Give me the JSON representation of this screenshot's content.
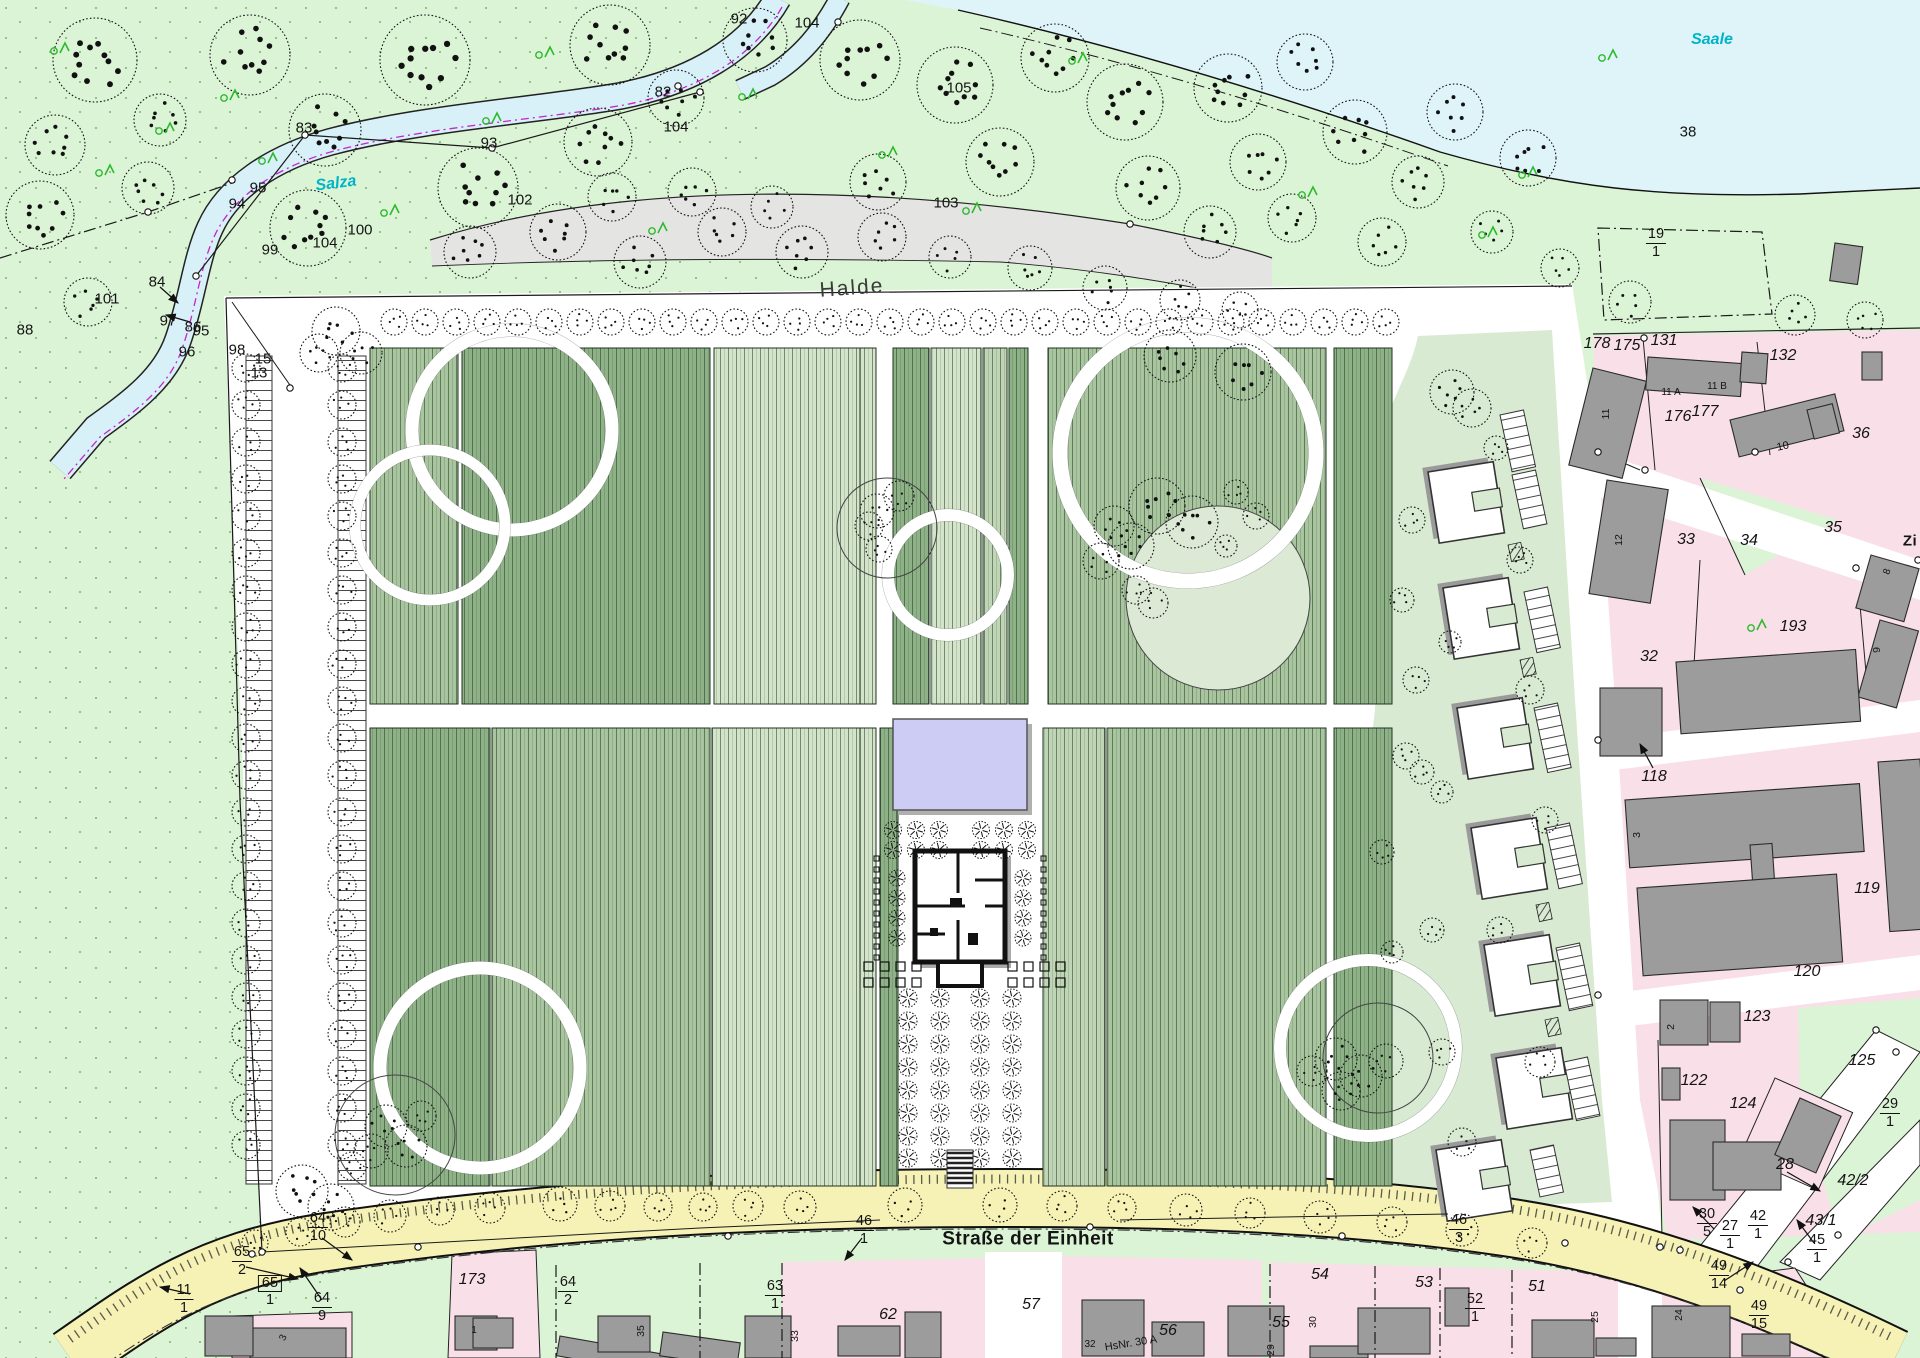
{
  "map": {
    "colors": {
      "meadow": "#dcf4d6",
      "field_dot": "#7fae74",
      "water": "#def4f8",
      "halde": "#e4e4e2",
      "park": "#ffffff",
      "plot_dark": "#8fb188",
      "plot_mid": "#a9c5a0",
      "plot_pale": "#d4e4cb",
      "plot_mix": "#c0d5b6",
      "pavilion_strip": "#d8ead2",
      "residential": "#f9dfe8",
      "building": "#9c9c9c",
      "road_yellow": "#f6f2b6",
      "pond": "#ccccf4",
      "river_label": "#00b4c8",
      "green_symbol": "#2db92d",
      "line": "#1a1a1a"
    },
    "labels": [
      {
        "t": "83",
        "x": 304,
        "y": 128
      },
      {
        "t": "93",
        "x": 489,
        "y": 143
      },
      {
        "t": "95",
        "x": 258,
        "y": 188
      },
      {
        "t": "94",
        "x": 237,
        "y": 204
      },
      {
        "t": "102",
        "x": 520,
        "y": 200
      },
      {
        "t": "100",
        "x": 360,
        "y": 230
      },
      {
        "t": "104",
        "x": 325,
        "y": 243
      },
      {
        "t": "99",
        "x": 270,
        "y": 250
      },
      {
        "t": "84",
        "x": 157,
        "y": 282
      },
      {
        "t": "86",
        "x": 193,
        "y": 327
      },
      {
        "t": "96",
        "x": 187,
        "y": 352
      },
      {
        "t": "98",
        "x": 237,
        "y": 350
      },
      {
        "t": "15",
        "x": 263,
        "y": 359
      },
      {
        "t": "101",
        "x": 107,
        "y": 299
      },
      {
        "t": "97",
        "x": 168,
        "y": 321
      },
      {
        "t": "95",
        "x": 201,
        "y": 331
      },
      {
        "t": "88",
        "x": 25,
        "y": 330
      },
      {
        "t": "13",
        "x": 259,
        "y": 373
      },
      {
        "t": "92",
        "x": 739,
        "y": 19
      },
      {
        "t": "104",
        "x": 807,
        "y": 23
      },
      {
        "t": "82",
        "x": 663,
        "y": 92
      },
      {
        "t": "104",
        "x": 676,
        "y": 127
      },
      {
        "t": "105",
        "x": 959,
        "y": 88
      },
      {
        "t": "103",
        "x": 946,
        "y": 203
      },
      {
        "t": "Halde",
        "x": 852,
        "y": 288,
        "k": "area",
        "rot": -4
      },
      {
        "t": "Salza",
        "x": 336,
        "y": 184,
        "k": "river",
        "rot": -7
      },
      {
        "t": "Saale",
        "x": 1712,
        "y": 40,
        "k": "river"
      },
      {
        "t": "38",
        "x": 1688,
        "y": 132
      },
      {
        "t": "19/1",
        "x": 1656,
        "y": 243,
        "k": "frac"
      },
      {
        "t": "178",
        "x": 1597,
        "y": 344,
        "k": "i"
      },
      {
        "t": "175",
        "x": 1627,
        "y": 346,
        "k": "i"
      },
      {
        "t": "131",
        "x": 1664,
        "y": 341,
        "k": "i"
      },
      {
        "t": "132",
        "x": 1783,
        "y": 356,
        "k": "i"
      },
      {
        "t": "11 A",
        "x": 1671,
        "y": 393,
        "fs": 10
      },
      {
        "t": "11 B",
        "x": 1717,
        "y": 387,
        "fs": 10
      },
      {
        "t": "11",
        "x": 1606,
        "y": 414,
        "k": "v"
      },
      {
        "t": "176",
        "x": 1678,
        "y": 417,
        "k": "i"
      },
      {
        "t": "177",
        "x": 1705,
        "y": 412,
        "k": "i"
      },
      {
        "t": "10",
        "x": 1783,
        "y": 447,
        "fs": 11,
        "rot": -12
      },
      {
        "t": "36",
        "x": 1861,
        "y": 434,
        "k": "i"
      },
      {
        "t": "33",
        "x": 1686,
        "y": 540,
        "k": "i"
      },
      {
        "t": "34",
        "x": 1749,
        "y": 541,
        "k": "i"
      },
      {
        "t": "35",
        "x": 1833,
        "y": 528,
        "k": "i"
      },
      {
        "t": "12",
        "x": 1619,
        "y": 540,
        "k": "v"
      },
      {
        "t": "193",
        "x": 1793,
        "y": 627,
        "k": "i"
      },
      {
        "t": "Zi",
        "x": 1910,
        "y": 541,
        "k": "street",
        "fs": 15
      },
      {
        "t": "8",
        "x": 1888,
        "y": 572,
        "fs": 10,
        "rot": -70
      },
      {
        "t": "9",
        "x": 1877,
        "y": 650,
        "k": "v"
      },
      {
        "t": "32",
        "x": 1649,
        "y": 657,
        "k": "i"
      },
      {
        "t": "118",
        "x": 1654,
        "y": 777,
        "k": "i"
      },
      {
        "t": "3",
        "x": 1637,
        "y": 835,
        "k": "v"
      },
      {
        "t": "119",
        "x": 1867,
        "y": 889,
        "k": "i"
      },
      {
        "t": "120",
        "x": 1807,
        "y": 972,
        "k": "i"
      },
      {
        "t": "2",
        "x": 1671,
        "y": 1027,
        "k": "v"
      },
      {
        "t": "123",
        "x": 1757,
        "y": 1017,
        "k": "i"
      },
      {
        "t": "122",
        "x": 1694,
        "y": 1081,
        "k": "i"
      },
      {
        "t": "124",
        "x": 1743,
        "y": 1104,
        "k": "i"
      },
      {
        "t": "125",
        "x": 1862,
        "y": 1061,
        "k": "i"
      },
      {
        "t": "28",
        "x": 1785,
        "y": 1165,
        "k": "i"
      },
      {
        "t": "29/1",
        "x": 1890,
        "y": 1113,
        "k": "frac"
      },
      {
        "t": "42/2",
        "x": 1853,
        "y": 1181,
        "k": "i"
      },
      {
        "t": "43/1",
        "x": 1821,
        "y": 1221,
        "k": "i"
      },
      {
        "t": "30/5",
        "x": 1707,
        "y": 1223,
        "k": "frac"
      },
      {
        "t": "27/1",
        "x": 1730,
        "y": 1235,
        "k": "frac"
      },
      {
        "t": "42/1",
        "x": 1758,
        "y": 1225,
        "k": "frac"
      },
      {
        "t": "45/1",
        "x": 1817,
        "y": 1249,
        "k": "frac"
      },
      {
        "t": "49/14",
        "x": 1719,
        "y": 1275,
        "k": "frac"
      },
      {
        "t": "49/15",
        "x": 1759,
        "y": 1315,
        "k": "frac"
      },
      {
        "t": "24",
        "x": 1679,
        "y": 1315,
        "k": "v"
      },
      {
        "t": "25",
        "x": 1595,
        "y": 1317,
        "k": "v"
      },
      {
        "t": "Straße der Einheit",
        "x": 1028,
        "y": 1239,
        "k": "street"
      },
      {
        "t": "46/1",
        "x": 864,
        "y": 1230,
        "k": "frac"
      },
      {
        "t": "46/3",
        "x": 1459,
        "y": 1229,
        "k": "frac"
      },
      {
        "t": "64/10",
        "x": 318,
        "y": 1227,
        "k": "frac"
      },
      {
        "t": "65/2",
        "x": 242,
        "y": 1261,
        "k": "frac"
      },
      {
        "t": "65/1",
        "x": 270,
        "y": 1291,
        "k": "fracbox"
      },
      {
        "t": "11/1",
        "x": 184,
        "y": 1299,
        "k": "frac"
      },
      {
        "t": "64/9",
        "x": 322,
        "y": 1307,
        "k": "frac"
      },
      {
        "t": "173",
        "x": 472,
        "y": 1280,
        "k": "i"
      },
      {
        "t": "1",
        "x": 474,
        "y": 1331,
        "fs": 10
      },
      {
        "t": "3",
        "x": 284,
        "y": 1338,
        "fs": 10,
        "rot": -65
      },
      {
        "t": "64/2",
        "x": 568,
        "y": 1291,
        "k": "frac"
      },
      {
        "t": "63/1",
        "x": 775,
        "y": 1295,
        "k": "frac"
      },
      {
        "t": "62",
        "x": 888,
        "y": 1315,
        "k": "i"
      },
      {
        "t": "57",
        "x": 1031,
        "y": 1305,
        "k": "i"
      },
      {
        "t": "56",
        "x": 1168,
        "y": 1331,
        "k": "i"
      },
      {
        "t": "HsNr. 30 A",
        "x": 1131,
        "y": 1344,
        "fs": 11,
        "rot": -9
      },
      {
        "t": "55",
        "x": 1281,
        "y": 1323,
        "k": "i"
      },
      {
        "t": "54",
        "x": 1320,
        "y": 1275,
        "k": "i"
      },
      {
        "t": "53",
        "x": 1424,
        "y": 1283,
        "k": "i"
      },
      {
        "t": "52/1",
        "x": 1475,
        "y": 1308,
        "k": "frac"
      },
      {
        "t": "51",
        "x": 1537,
        "y": 1287,
        "k": "i"
      },
      {
        "t": "30",
        "x": 1313,
        "y": 1322,
        "k": "v"
      },
      {
        "t": "29",
        "x": 1271,
        "y": 1350,
        "k": "v"
      },
      {
        "t": "35",
        "x": 641,
        "y": 1331,
        "k": "v"
      },
      {
        "t": "33",
        "x": 795,
        "y": 1336,
        "k": "v"
      },
      {
        "t": "32",
        "x": 1090,
        "y": 1345,
        "fs": 10
      }
    ]
  }
}
